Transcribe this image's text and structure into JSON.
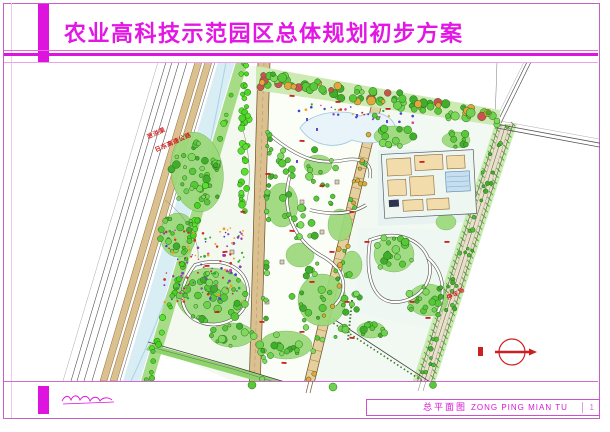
{
  "header": {
    "title": "农业高科技示范园区总体规划初步方案"
  },
  "map": {
    "labels": {
      "river": "泄洪渠",
      "highway": "日东高速公路",
      "parking": "停车场"
    },
    "icons": {
      "north_arrow": "north-arrow-icon",
      "signature": "signature-scribble"
    }
  },
  "footer": {
    "sheet_title_cn": "总平面图",
    "sheet_title_pinyin": "ZONG PING MIAN TU",
    "sheet_number": "1"
  },
  "colors": {
    "frame_magenta": "#de14de",
    "border_pink": "#c75fc7",
    "road_tan": "#dcc190",
    "water_blue": "#d9edf5",
    "tree_green": "#57c838",
    "marker_red": "#cc2020"
  }
}
